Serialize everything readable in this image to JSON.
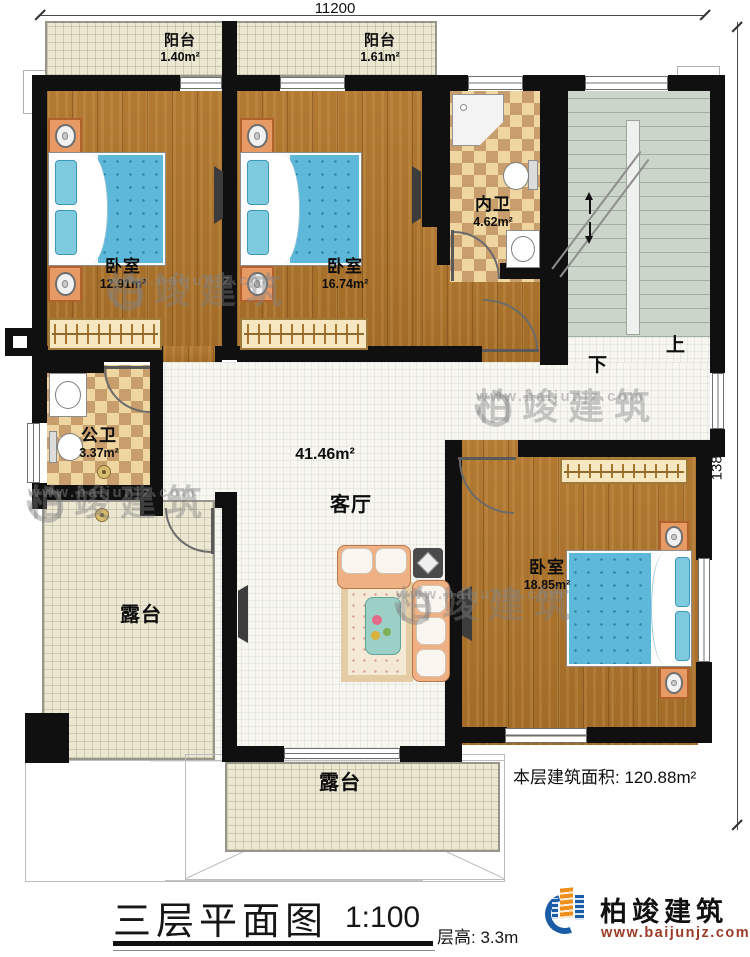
{
  "dims": {
    "width_top": "11200",
    "height_right": "13800"
  },
  "rooms": {
    "balcony_left": {
      "name": "阳台",
      "area": "1.40m²"
    },
    "balcony_right": {
      "name": "阳台",
      "area": "1.61m²"
    },
    "bedroom_left": {
      "name": "卧室",
      "area": "12.91m²"
    },
    "bedroom_mid": {
      "name": "卧室",
      "area": "16.74m²"
    },
    "bath_ensuite": {
      "name": "内卫",
      "area": "4.62m²"
    },
    "bath_public": {
      "name": "公卫",
      "area": "3.37m²"
    },
    "living": {
      "name": "客厅",
      "area": "41.46m²"
    },
    "bedroom_master": {
      "name": "卧室",
      "area": "18.85m²"
    },
    "terrace_left": {
      "name": "露台"
    },
    "terrace_bottom": {
      "name": "露台"
    }
  },
  "stairs": {
    "up_label": "上",
    "down_label": "下"
  },
  "annotations": {
    "floor_area": "本层建筑面积: 120.88m²"
  },
  "titleblock": {
    "title": "三层平面图",
    "scale": "1:100",
    "floor_height": "层高: 3.3m"
  },
  "brand": {
    "name": "柏竣建筑",
    "website": "www.baijunjz.com"
  },
  "watermark": {
    "name": "柏竣建筑",
    "website": "www.baijunjz.com"
  },
  "colors": {
    "wall": "#101010",
    "wood": "#aa722e",
    "mattress": "#5db8d9",
    "brand_blue": "#1b5ca7",
    "brand_orange": "#ef8f1c",
    "site_red": "#9c3b28"
  }
}
